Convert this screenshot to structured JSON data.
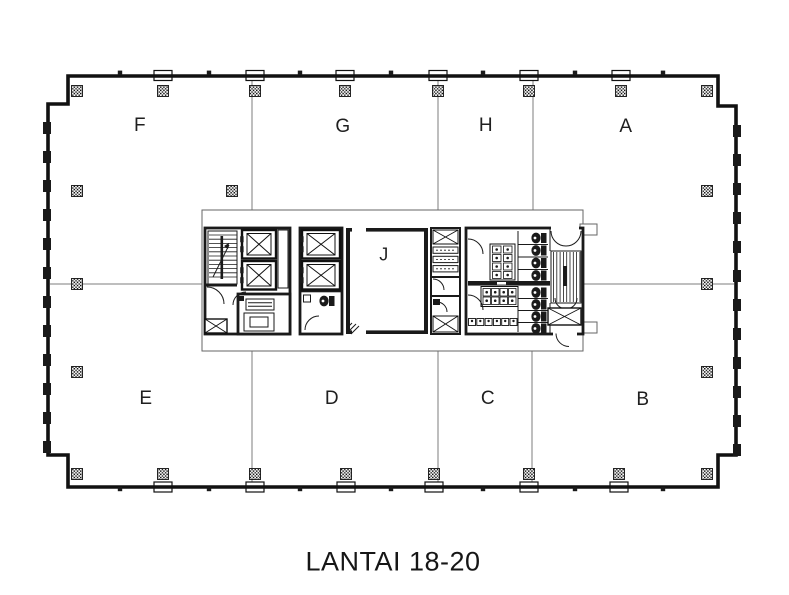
{
  "title": {
    "text": "LANTAI 18-20"
  },
  "zones": {
    "F": "F",
    "G": "G",
    "H": "H",
    "A": "A",
    "E": "E",
    "D": "D",
    "C": "C",
    "B": "B",
    "J": "J"
  },
  "colors": {
    "background": "#ffffff",
    "ink": "#1a1a1a",
    "boundary_line": "#7d7d7d"
  }
}
